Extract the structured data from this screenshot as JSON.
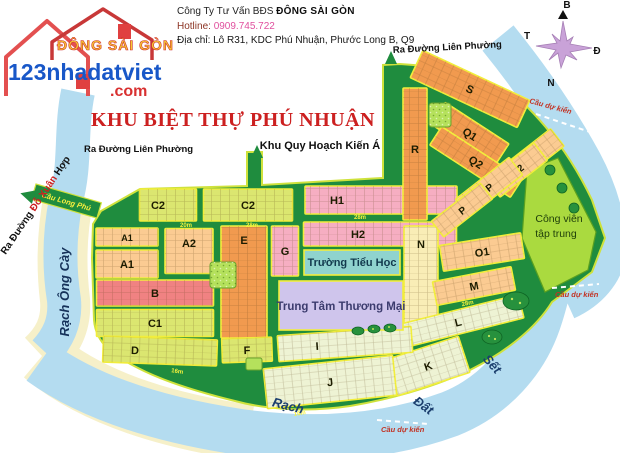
{
  "header": {
    "company_prefix": "Công Ty Tư Vấn BĐS ",
    "company_name": "ĐÔNG SÀI GÒN",
    "hotline_label": "Hotline: ",
    "hotline_number": "0909.745.722",
    "address_label": "Địa chỉ: ",
    "address_value": "Lô R31, KDC Phú Nhuận, Phước Long B, Q9"
  },
  "logo": {
    "brand": "ĐÔNG SÀI GÒN",
    "site": "123nhadatviet",
    "tld": ".com"
  },
  "compass": {
    "north": "B",
    "west": "T",
    "east": "Đ",
    "south": "N"
  },
  "map": {
    "title": "KHU BIỆT THỰ PHÚ NHUẬN",
    "labels": {
      "lien_phuong_left": "Ra Đường Liên Phường",
      "lien_phuong_top": "Ra Đường Liên Phường",
      "kien_a": "Khu Quy Hoạch Kiến Á",
      "do_xuan_hop_1": "Ra Đường ",
      "do_xuan_hop_2": "Đỗ Xuân ",
      "do_xuan_hop_3": "Hợp",
      "rach_ong_cay": "Rạch Ông Cày",
      "cau_long_phu": "Cầu Long Phú",
      "rach": "Rạch",
      "dat": "Đất",
      "set": "Sết",
      "cau_du_kien_1": "Cầu dự kiến",
      "cau_du_kien_2": "Cầu dự kiến",
      "cau_du_kien_3": "Cầu dự kiến",
      "school": "Trường Tiểu Học",
      "market": "Trung Tâm Thương Mại",
      "park_1": "Công viên",
      "park_2": "tập trung"
    },
    "palette": {
      "yg": "#dbe670",
      "peach": "#fbcb92",
      "orange": "#f19a4f",
      "pink": "#f6aec2",
      "red": "#f08282",
      "cream": "#f9edb6",
      "lg": "#eef3d4"
    },
    "colors": {
      "land_green": "#1f8c3e",
      "water_blue": "#b4dcf0",
      "bank_cream": "#f6f0c9",
      "trim_yellow": "#f2ee3c",
      "park_green": "#aada3f",
      "title_red": "#cc2020"
    },
    "blocks": [
      {
        "label": "C2",
        "cx": 168,
        "cy": 205,
        "w": 57,
        "h": 32,
        "rot": 0,
        "color": "yg",
        "ldx": -10,
        "ldy": 0
      },
      {
        "label": "C2",
        "cx": 248,
        "cy": 205,
        "w": 89,
        "h": 32,
        "rot": 0,
        "color": "yg"
      },
      {
        "label": "H1",
        "cx": 381,
        "cy": 200,
        "w": 152,
        "h": 28,
        "rot": 0,
        "color": "pink",
        "ldx": -44
      },
      {
        "label": "H2",
        "cx": 380,
        "cy": 234,
        "w": 153,
        "h": 24,
        "rot": 0,
        "color": "pink",
        "ldx": -22
      },
      {
        "label": "A1",
        "cx": 127,
        "cy": 237,
        "w": 62,
        "h": 18,
        "rot": 0,
        "color": "peach",
        "fs": 9
      },
      {
        "label": "A2",
        "cx": 189,
        "cy": 251,
        "w": 48,
        "h": 45,
        "rot": 0,
        "color": "peach",
        "ldy": -8
      },
      {
        "label": "A1",
        "cx": 127,
        "cy": 264,
        "w": 62,
        "h": 28,
        "rot": 0,
        "color": "peach"
      },
      {
        "label": "E",
        "cx": 244,
        "cy": 282,
        "w": 46,
        "h": 112,
        "rot": 0,
        "color": "orange",
        "ldy": -42
      },
      {
        "label": "G",
        "cx": 285,
        "cy": 251,
        "w": 27,
        "h": 50,
        "rot": 0,
        "color": "pink"
      },
      {
        "label": "B",
        "cx": 155,
        "cy": 293,
        "w": 117,
        "h": 26,
        "rot": 0,
        "color": "red"
      },
      {
        "label": "C1",
        "cx": 155,
        "cy": 323,
        "w": 117,
        "h": 27,
        "rot": 0,
        "color": "yg"
      },
      {
        "label": "D",
        "cx": 160,
        "cy": 351,
        "w": 114,
        "h": 26,
        "rot": 2,
        "color": "yg",
        "ldx": -25
      },
      {
        "label": "F",
        "cx": 247,
        "cy": 350,
        "w": 50,
        "h": 24,
        "rot": -2,
        "color": "yg"
      },
      {
        "label": "N",
        "cx": 421,
        "cy": 280,
        "w": 34,
        "h": 108,
        "rot": 0,
        "color": "cream",
        "ldy": -36
      },
      {
        "label": "R",
        "cx": 415,
        "cy": 154,
        "w": 24,
        "h": 132,
        "rot": 0,
        "color": "orange",
        "ldy": -5
      },
      {
        "label": "S",
        "cx": 470,
        "cy": 89,
        "w": 118,
        "h": 30,
        "rot": 25,
        "color": "orange"
      },
      {
        "label": "Q1",
        "cx": 470,
        "cy": 134,
        "w": 76,
        "h": 26,
        "rot": 33,
        "color": "orange"
      },
      {
        "label": "Q2",
        "cx": 476,
        "cy": 162,
        "w": 96,
        "h": 22,
        "rot": 33,
        "color": "orange"
      },
      {
        "label": "T",
        "cx": 536,
        "cy": 154,
        "w": 54,
        "h": 22,
        "rot": -38,
        "color": "peach",
        "fs": 10
      },
      {
        "label": "O2",
        "cx": 517,
        "cy": 170,
        "w": 60,
        "h": 22,
        "rot": -38,
        "color": "peach",
        "fs": 10
      },
      {
        "label": "P",
        "cx": 489,
        "cy": 187,
        "w": 68,
        "h": 22,
        "rot": -38,
        "color": "peach",
        "fs": 10
      },
      {
        "label": "P",
        "cx": 462,
        "cy": 210,
        "w": 62,
        "h": 20,
        "rot": -38,
        "color": "peach",
        "fs": 10
      },
      {
        "label": "O1",
        "cx": 482,
        "cy": 252,
        "w": 82,
        "h": 26,
        "rot": -9,
        "color": "peach"
      },
      {
        "label": "M",
        "cx": 474,
        "cy": 286,
        "w": 80,
        "h": 24,
        "rot": -11,
        "color": "peach"
      },
      {
        "label": "L",
        "cx": 458,
        "cy": 322,
        "w": 130,
        "h": 24,
        "rot": -14,
        "color": "lg"
      },
      {
        "label": "K",
        "cx": 428,
        "cy": 366,
        "w": 76,
        "h": 38,
        "rot": -18,
        "color": "lg"
      },
      {
        "label": "I",
        "cx": 345,
        "cy": 344,
        "w": 134,
        "h": 26,
        "rot": -4,
        "color": "lg",
        "ldx": -28
      },
      {
        "label": "J",
        "cx": 330,
        "cy": 382,
        "w": 130,
        "h": 40,
        "rot": -6,
        "color": "lg"
      }
    ],
    "road_labels": [
      {
        "t": "20m",
        "x": 186,
        "y": 227,
        "r": 0
      },
      {
        "t": "28m",
        "x": 252,
        "y": 227,
        "r": 0
      },
      {
        "t": "28m",
        "x": 360,
        "y": 219,
        "r": 0
      },
      {
        "t": "28m",
        "x": 468,
        "y": 305,
        "r": -12
      },
      {
        "t": "16m",
        "x": 177,
        "y": 373,
        "r": 8
      },
      {
        "t": "16m",
        "x": 300,
        "y": 415,
        "r": -8
      }
    ]
  }
}
